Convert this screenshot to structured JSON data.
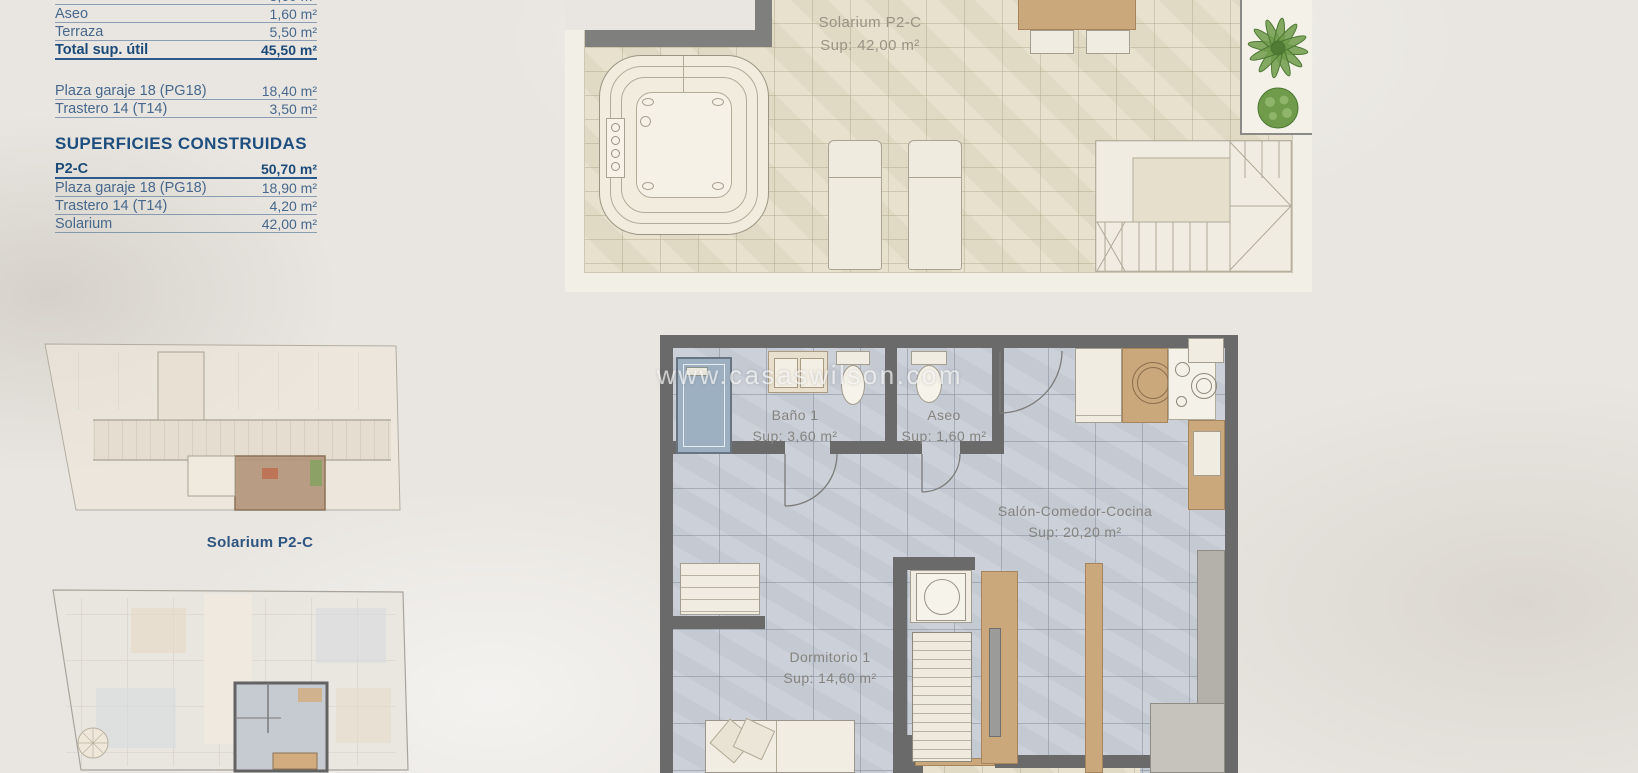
{
  "page": {
    "watermark": "www.casaswilson.com",
    "background": "#e9e6e1"
  },
  "colors": {
    "accent_navy": "#1d4e7e",
    "table_blue": "#47688c",
    "wall_gray": "#6a6a6a",
    "tile_beige": "#e6dfcb",
    "floor_gray": "#c9ced6",
    "wood": "#cba77c",
    "highlight_tan": "#b2957a",
    "plant_green": "#6f9b4a"
  },
  "summary_table": {
    "useful_rows": [
      {
        "label": "Baño 1",
        "value": "3,60 m²"
      },
      {
        "label": "Aseo",
        "value": "1,60 m²"
      },
      {
        "label": "Terraza",
        "value": "5,50 m²"
      },
      {
        "label": "Total sup. útil",
        "value": "45,50 m²"
      }
    ],
    "annex_rows": [
      {
        "label": "Plaza garaje 18 (PG18)",
        "value": "18,40 m²"
      },
      {
        "label": "Trastero 14 (T14)",
        "value": "3,50 m²"
      }
    ],
    "built_heading": "SUPERFICIES CONSTRUIDAS",
    "built_rows": [
      {
        "label": "P2-C",
        "value": "50,70 m²"
      },
      {
        "label": "Plaza garaje 18 (PG18)",
        "value": "18,90 m²"
      },
      {
        "label": "Trastero 14 (T14)",
        "value": "4,20 m²"
      },
      {
        "label": "Solarium",
        "value": "42,00 m²"
      }
    ]
  },
  "solarium_plan": {
    "title": "Solarium P2-C",
    "area": "Sup: 42,00 m²"
  },
  "overview": {
    "caption": "Solarium P2-C"
  },
  "apartment_plan": {
    "rooms": [
      {
        "name": "Baño 1",
        "area": "Sup: 3,60 m²"
      },
      {
        "name": "Aseo",
        "area": "Sup: 1,60 m²"
      },
      {
        "name": "Salón-Comedor-Cocina",
        "area": "Sup: 20,20 m²"
      },
      {
        "name": "Dormitorio 1",
        "area": "Sup: 14,60 m²"
      }
    ]
  }
}
